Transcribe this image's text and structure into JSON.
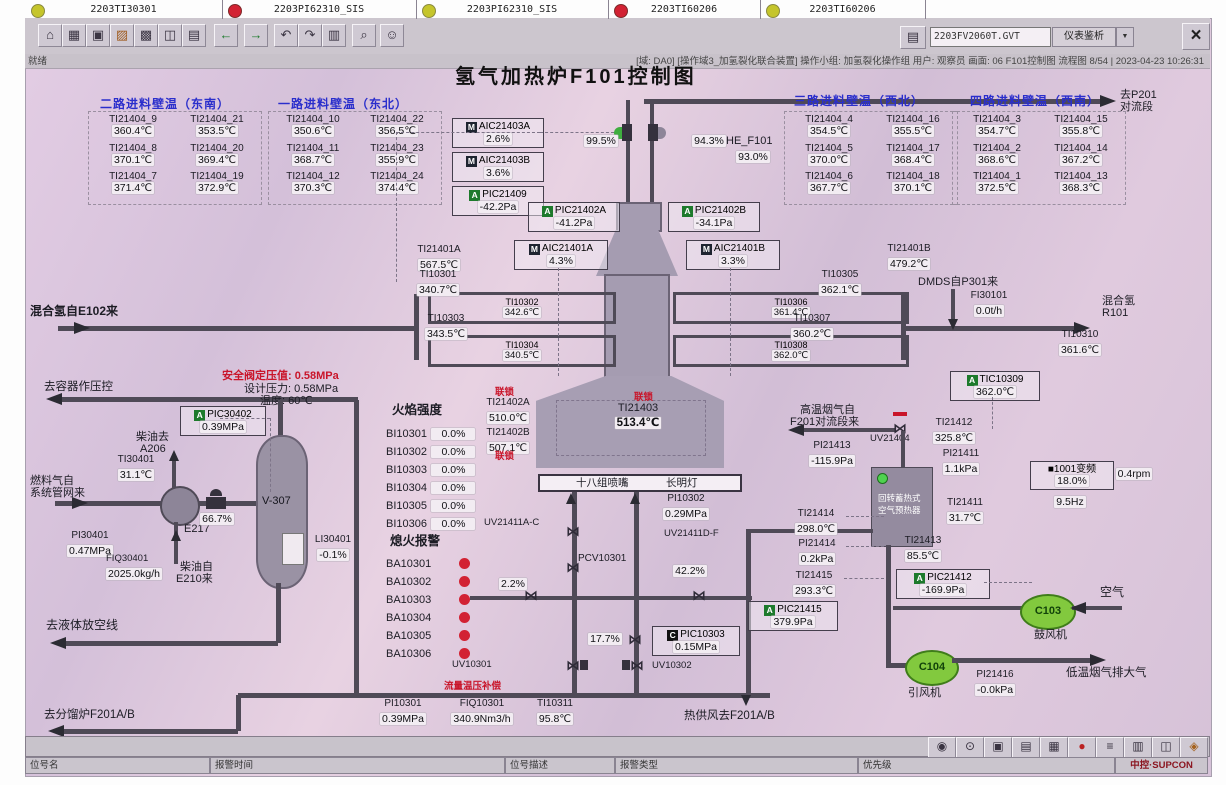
{
  "toolbar": {
    "left_icons": [
      {
        "name": "home-icon",
        "glyph": "⌂"
      },
      {
        "name": "overview-icon",
        "glyph": "▦"
      },
      {
        "name": "window-icon",
        "glyph": "▣"
      },
      {
        "name": "furnace-graphic-icon",
        "glyph": "▨"
      },
      {
        "name": "grid-icon",
        "glyph": "▩"
      },
      {
        "name": "instrument-icon",
        "glyph": "◫"
      },
      {
        "name": "report-icon",
        "glyph": "▤"
      },
      {
        "name": "back-icon",
        "glyph": "←"
      },
      {
        "name": "forward-icon",
        "glyph": "→"
      },
      {
        "name": "page-prev-icon",
        "glyph": "↶"
      },
      {
        "name": "page-next-icon",
        "glyph": "↷"
      },
      {
        "name": "book-icon",
        "glyph": "▥"
      },
      {
        "name": "search-icon",
        "glyph": "⌕"
      },
      {
        "name": "user-icon",
        "glyph": "☺"
      }
    ],
    "printer_glyph": "▤",
    "tag_field": "2203FV2060T.GVT",
    "dropdown_label": "仪表鉴析",
    "dropdown_arrow": "▼",
    "close_glyph": "×",
    "ready": "就绪",
    "session": "[域: DA0] [操作域3_加氢裂化联合装置] 操作小组: 加氢裂化操作组  用户: 观察员  画面: 06 F101控制图 流程图 8/54 | 2023-04-23 10:26:31"
  },
  "title": "氢气加热炉F101控制图",
  "groups": [
    {
      "title": "二路进料壁温（东南）",
      "cells": [
        {
          "tag": "TI21404_9",
          "val": "360.4℃"
        },
        {
          "tag": "TI21404_21",
          "val": "353.5℃"
        },
        {
          "tag": "TI21404_8",
          "val": "370.1℃"
        },
        {
          "tag": "TI21404_20",
          "val": "369.4℃"
        },
        {
          "tag": "TI21404_7",
          "val": "371.4℃"
        },
        {
          "tag": "TI21404_19",
          "val": "372.9℃"
        }
      ]
    },
    {
      "title": "一路进料壁温（东北）",
      "cells": [
        {
          "tag": "TI21404_10",
          "val": "350.6℃"
        },
        {
          "tag": "TI21404_22",
          "val": "356.5℃"
        },
        {
          "tag": "TI21404_11",
          "val": "368.7℃"
        },
        {
          "tag": "TI21404_23",
          "val": "355.9℃"
        },
        {
          "tag": "TI21404_12",
          "val": "370.3℃"
        },
        {
          "tag": "TI21404_24",
          "val": "374.4℃"
        }
      ]
    },
    {
      "title": "三路进料壁温（西北）",
      "cells": [
        {
          "tag": "TI21404_4",
          "val": "354.5℃"
        },
        {
          "tag": "TI21404_16",
          "val": "355.5℃"
        },
        {
          "tag": "TI21404_5",
          "val": "370.0℃"
        },
        {
          "tag": "TI21404_17",
          "val": "368.4℃"
        },
        {
          "tag": "TI21404_6",
          "val": "367.7℃"
        },
        {
          "tag": "TI21404_18",
          "val": "370.1℃"
        }
      ]
    },
    {
      "title": "四路进料壁温（西南）",
      "cells": [
        {
          "tag": "TI21404_3",
          "val": "354.7℃"
        },
        {
          "tag": "TI21404_15",
          "val": "355.8℃"
        },
        {
          "tag": "TI21404_2",
          "val": "368.6℃"
        },
        {
          "tag": "TI21404_14",
          "val": "367.2℃"
        },
        {
          "tag": "TI21404_1",
          "val": "372.5℃"
        },
        {
          "tag": "TI21404_13",
          "val": "368.3℃"
        }
      ]
    }
  ],
  "dest": {
    "l1": "去P201",
    "l2": "对流段"
  },
  "stack": {
    "v_left": "99.5%",
    "v_right": "94.3%",
    "he_tag": "HE_F101",
    "he_val": "93.0%"
  },
  "inst": {
    "aic21403a": {
      "b": "M",
      "tag": "AIC21403A",
      "val": "2.6%"
    },
    "aic21403b": {
      "b": "M",
      "tag": "AIC21403B",
      "val": "3.6%"
    },
    "pic21409": {
      "b": "A",
      "tag": "PIC21409",
      "val": "-42.2Pa"
    },
    "pic21402a": {
      "b": "A",
      "tag": "PIC21402A",
      "val": "-41.2Pa"
    },
    "pic21402b": {
      "b": "A",
      "tag": "PIC21402B",
      "val": "-34.1Pa"
    },
    "aic21401a": {
      "b": "M",
      "tag": "AIC21401A",
      "val": "4.3%"
    },
    "aic21401b": {
      "b": "M",
      "tag": "AIC21401B",
      "val": "3.3%"
    },
    "tic10309": {
      "b": "A",
      "tag": "TIC10309",
      "val": "362.0℃"
    },
    "pic30402": {
      "b": "A",
      "tag": "PIC30402",
      "val": "0.39MPa"
    },
    "pic10303": {
      "b": "C",
      "tag": "PIC10303",
      "val": "0.15MPa"
    },
    "pic21412": {
      "b": "A",
      "tag": "PIC21412",
      "val": "-169.9Pa"
    },
    "pic21415": {
      "b": "A",
      "tag": "PIC21415",
      "val": "379.9Pa"
    }
  },
  "tags": {
    "ti21401a": {
      "t": "TI21401A",
      "v": "567.5℃"
    },
    "ti21401b": {
      "t": "TI21401B",
      "v": "479.2℃"
    },
    "ti10301": {
      "t": "TI10301",
      "v": "340.7℃"
    },
    "ti10302": {
      "t": "TI10302",
      "v": "342.6℃"
    },
    "ti10303": {
      "t": "TI10303",
      "v": "343.5℃"
    },
    "ti10304": {
      "t": "TI10304",
      "v": "340.5℃"
    },
    "ti10305": {
      "t": "TI10305",
      "v": "362.1℃"
    },
    "ti10306": {
      "t": "TI10306",
      "v": "361.4℃"
    },
    "ti10307": {
      "t": "TI10307",
      "v": "360.2℃"
    },
    "ti10308": {
      "t": "TI10308",
      "v": "362.0℃"
    },
    "ti10310": {
      "t": "TI10310",
      "v": "361.6℃"
    },
    "fi30101": {
      "t": "FI30101",
      "v": "0.0t/h"
    },
    "ti21402a": {
      "t": "TI21402A",
      "v": "510.0℃"
    },
    "ti21402b": {
      "t": "TI21402B",
      "v": "507.1℃"
    },
    "ti21403": {
      "t": "TI21403",
      "v": "513.4℃"
    },
    "ti30401": {
      "t": "TI30401",
      "v": "31.1℃"
    },
    "pi30401": {
      "t": "PI30401",
      "v": "0.47MPa"
    },
    "fiq30401": {
      "t": "FIQ30401",
      "v": "2025.0kg/h"
    },
    "li30401": {
      "t": "LI30401",
      "v": "-0.1%"
    },
    "pi10302": {
      "t": "PI10302",
      "v": "0.29MPa"
    },
    "pi10301": {
      "t": "PI10301",
      "v": "0.39MPa"
    },
    "fiq10301": {
      "t": "FIQ10301",
      "v": "340.9Nm3/h"
    },
    "ti10311": {
      "t": "TI10311",
      "v": "95.8℃"
    },
    "ti21412": {
      "t": "TI21412",
      "v": "325.8℃"
    },
    "pi21413": {
      "t": "PI21413",
      "v": "-115.9Pa"
    },
    "pi21411": {
      "t": "PI21411",
      "v": "1.1kPa"
    },
    "ti21411": {
      "t": "TI21411",
      "v": "31.7℃"
    },
    "ti21414": {
      "t": "TI21414",
      "v": "298.0℃"
    },
    "pi21414": {
      "t": "PI21414",
      "v": "0.2kPa"
    },
    "ti21415": {
      "t": "TI21415",
      "v": "293.3℃"
    },
    "ti21413": {
      "t": "TI21413",
      "v": "85.5℃"
    },
    "pi21416": {
      "t": "PI21416",
      "v": "-0.0kPa"
    }
  },
  "vals": {
    "v667": "66.7%",
    "v22": "2.2%",
    "v422": "42.2%",
    "v177": "17.7%"
  },
  "vfd": {
    "block": "■",
    "name": "1001变频",
    "pct": "18.0%",
    "hz": "9.5Hz",
    "rpm": "0.4rpm"
  },
  "fans": {
    "c103": "C103",
    "c103_name": "鼓风机",
    "c104": "C104",
    "c104_name": "引风机"
  },
  "labels": {
    "mix_in": "混合氢自E102来",
    "dmds": "DMDS自P301来",
    "mix_out1": "混合氢",
    "mix_out2": "R101",
    "il": "联锁",
    "burners": "十八组喷嘴",
    "pilot": "长明灯",
    "uv21411ac": "UV21411A-C",
    "pcv10301": "PCV10301",
    "uv21411df": "UV21411D-F",
    "uv10301": "UV10301",
    "uv10302": "UV10302",
    "flow_comp": "流量温压补偿",
    "hot_air": "热供风去F201A/B",
    "to_vessel": "去容器作压控",
    "sv_set": "安全阀定压值: 0.58MPa",
    "design_p": "设计压力: 0.58MPa",
    "design_t": "温度: 60℃",
    "diesel_to1": "柴油去",
    "diesel_to2": "A206",
    "fuel1": "燃料气自",
    "fuel2": "系统管网来",
    "e217": "E217",
    "v307": "V-307",
    "diesel_fr1": "柴油自",
    "diesel_fr2": "E210来",
    "to_vent": "去液体放空线",
    "to_f201": "去分馏炉F201A/B",
    "hot_flue1": "高温烟气自",
    "hot_flue2": "F201对流段来",
    "uv21404": "UV21404",
    "ph1": "回转蓄热式",
    "ph2": "空气预热器",
    "air": "空气",
    "cold_flue": "低温烟气排大气"
  },
  "bi": {
    "title": "火焰强度",
    "rows": [
      {
        "t": "BI10301",
        "v": "0.0%"
      },
      {
        "t": "BI10302",
        "v": "0.0%"
      },
      {
        "t": "BI10303",
        "v": "0.0%"
      },
      {
        "t": "BI10304",
        "v": "0.0%"
      },
      {
        "t": "BI10305",
        "v": "0.0%"
      },
      {
        "t": "BI10306",
        "v": "0.0%"
      }
    ]
  },
  "ba": {
    "title": "熄火报警",
    "rows": [
      "BA10301",
      "BA10302",
      "BA10303",
      "BA10304",
      "BA10305",
      "BA10306"
    ]
  },
  "alarm": {
    "cells": [
      {
        "color": "#c5c52b",
        "text": "2203TI30301"
      },
      {
        "color": "#d22233",
        "text": "2203PI62310_SIS"
      },
      {
        "color": "#c5c52b",
        "text": "2203PI62310_SIS"
      },
      {
        "color": "#d22233",
        "text": "2203TI60206"
      },
      {
        "color": "#c5c52b",
        "text": "2203TI60206"
      }
    ],
    "fields": [
      "位号名",
      "报警时间",
      "位号描述",
      "报警类型",
      "优先级"
    ],
    "right_icons": [
      {
        "name": "view-icon",
        "glyph": "◉"
      },
      {
        "name": "lock-icon",
        "glyph": "⊙"
      },
      {
        "name": "monitor-icon",
        "glyph": "▣"
      },
      {
        "name": "printer-icon",
        "glyph": "▤"
      },
      {
        "name": "table-icon",
        "glyph": "▦"
      },
      {
        "name": "alarm-bell-icon",
        "glyph": "●"
      },
      {
        "name": "list-icon",
        "glyph": "≡"
      },
      {
        "name": "document-icon",
        "glyph": "▥"
      },
      {
        "name": "layout-icon",
        "glyph": "◫"
      },
      {
        "name": "horn-icon",
        "glyph": "◈"
      }
    ],
    "brand": "中控·SUPCON"
  },
  "colors": {
    "accent_blue": "#2a2ecc",
    "red_text": "#c9152a",
    "alarm_red": "#d22233",
    "warn_yellow": "#c5c52b",
    "valve_green": "#3fae3f",
    "fan_green": "#82c93e",
    "pipe": "#4f4a57",
    "arrow": "#2b2b33"
  }
}
